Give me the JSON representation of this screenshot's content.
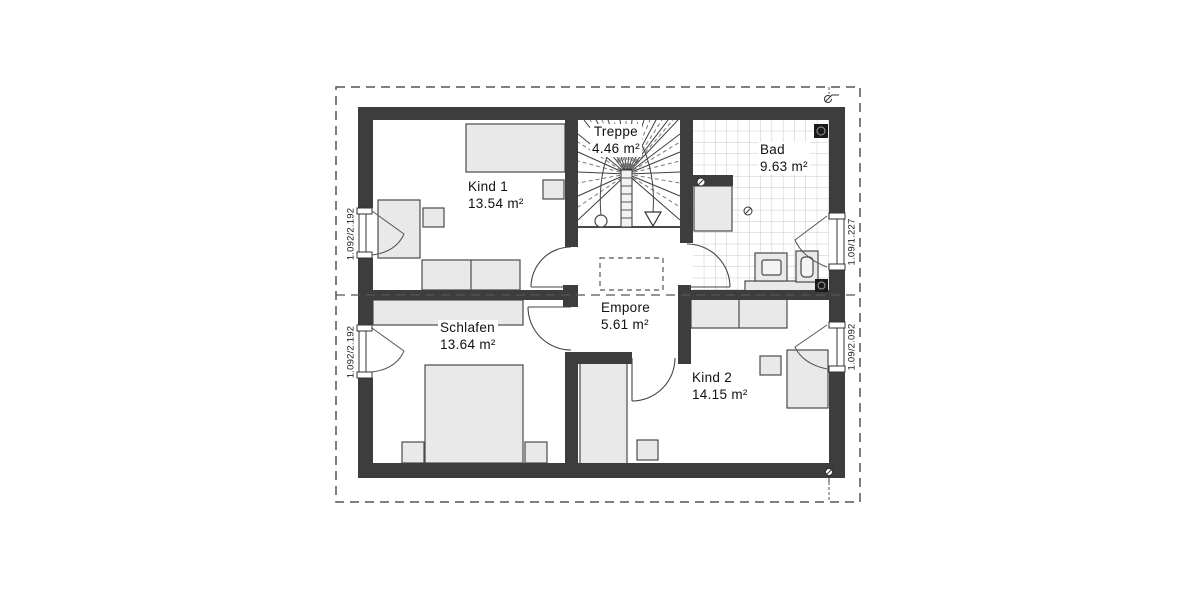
{
  "plan_type": "floor-plan",
  "rooms": [
    {
      "id": "kind1",
      "name": "Kind 1",
      "area": "13.54 m²"
    },
    {
      "id": "treppe",
      "name": "Treppe",
      "area": "4.46 m²"
    },
    {
      "id": "bad",
      "name": "Bad",
      "area": "9.63 m²"
    },
    {
      "id": "schlafen",
      "name": "Schlafen",
      "area": "13.64 m²"
    },
    {
      "id": "empore",
      "name": "Empore",
      "area": "5.61 m²"
    },
    {
      "id": "kind2",
      "name": "Kind 2",
      "area": "14.15 m²"
    }
  ],
  "window_labels": [
    "1.092/2.192",
    "1.092/2.192",
    "1.09/1.227",
    "1.09/2.092"
  ],
  "colors": {
    "wall": "#3d3d3d",
    "furniture_fill": "#e9e9e9",
    "furniture_stroke": "#4a4a4a",
    "tile_line": "#c9c9c9",
    "dash_line": "#555555",
    "background": "#ffffff"
  }
}
